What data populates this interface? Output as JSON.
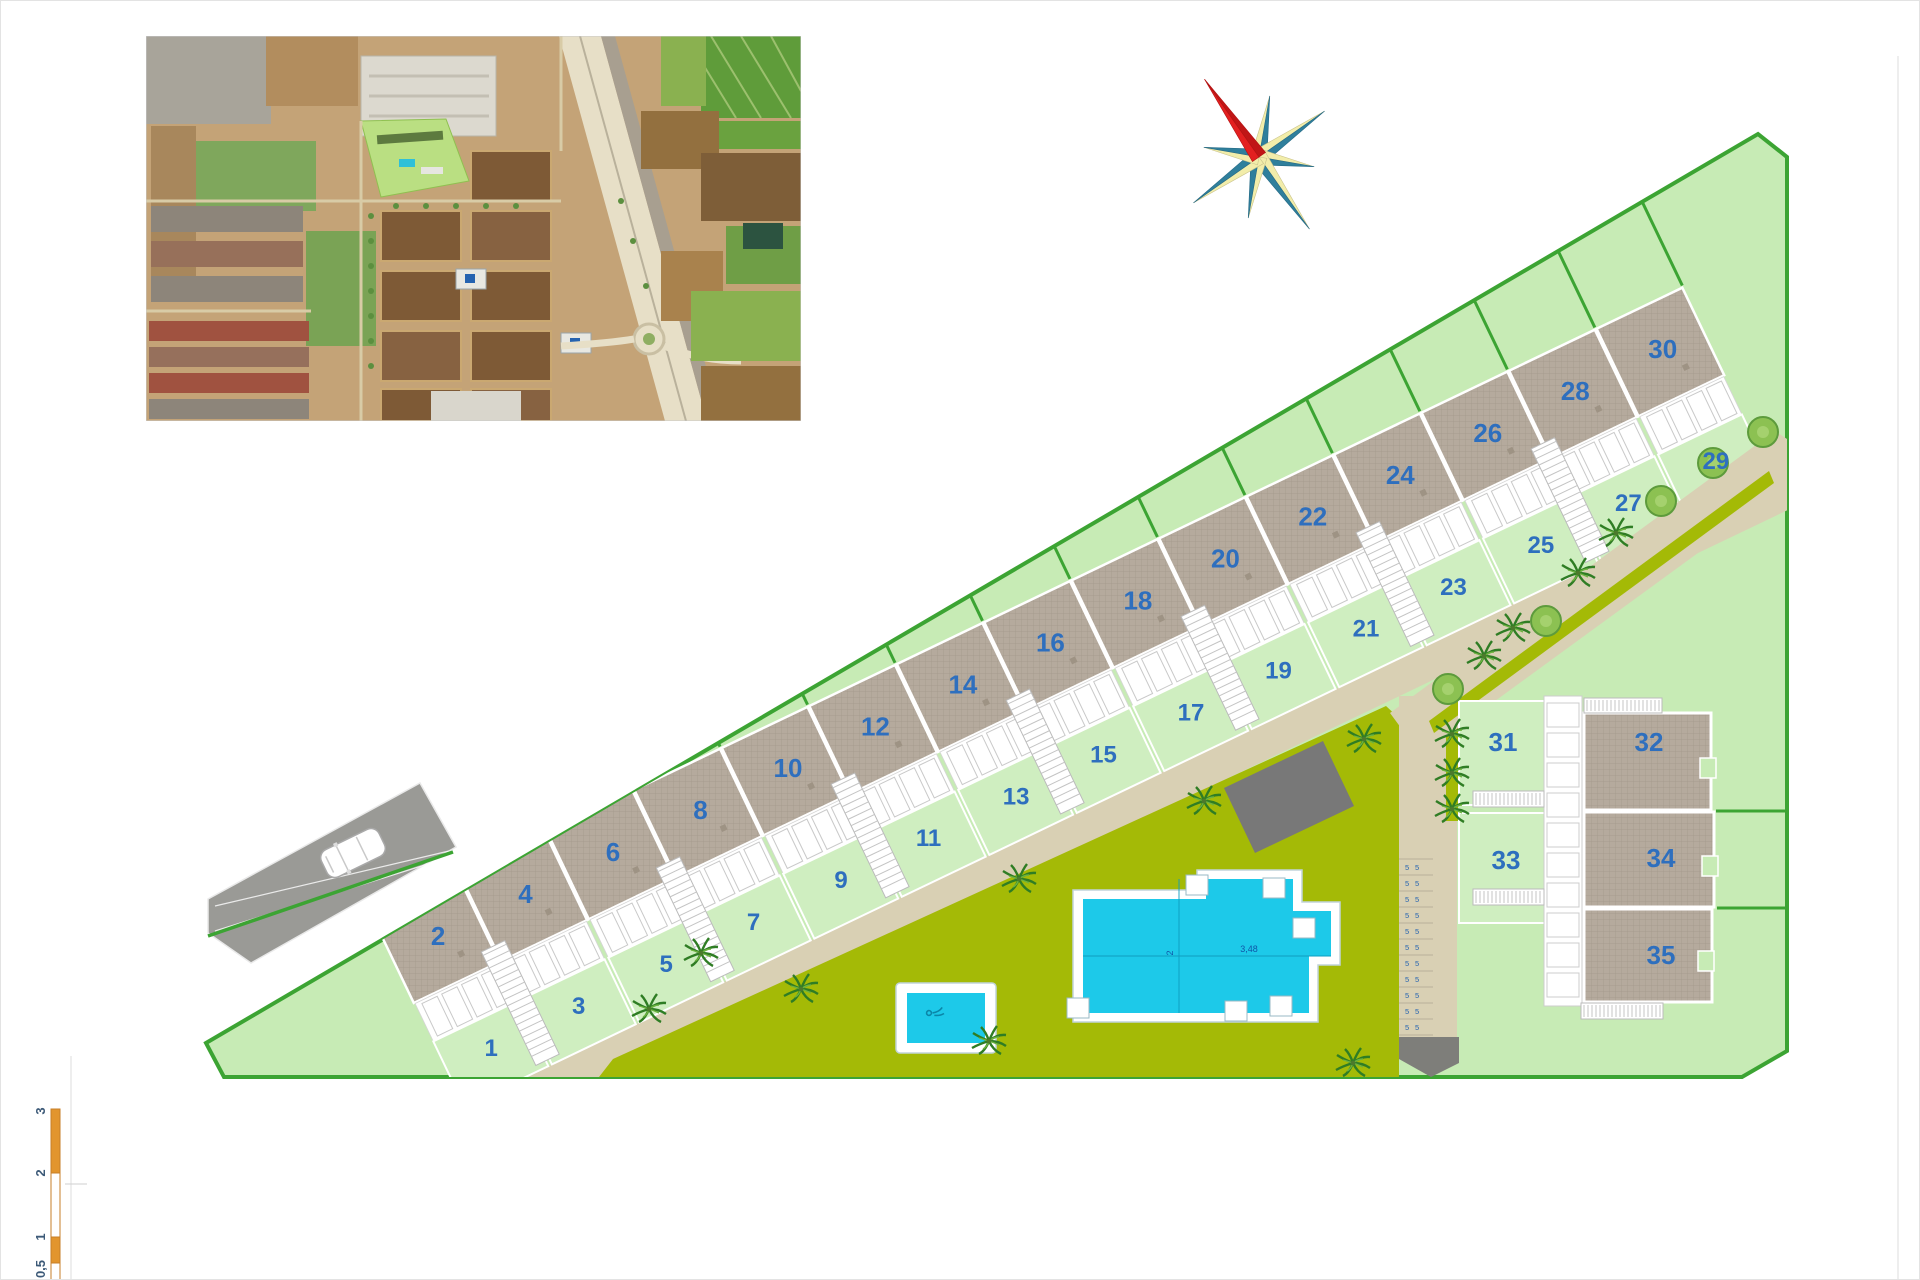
{
  "plan": {
    "row_units": [
      {
        "garden": "1",
        "roof": "2"
      },
      {
        "garden": "3",
        "roof": "4"
      },
      {
        "garden": "5",
        "roof": "6"
      },
      {
        "garden": "7",
        "roof": "8"
      },
      {
        "garden": "9",
        "roof": "10"
      },
      {
        "garden": "11",
        "roof": "12"
      },
      {
        "garden": "13",
        "roof": "14"
      },
      {
        "garden": "15",
        "roof": "16"
      },
      {
        "garden": "17",
        "roof": "18"
      },
      {
        "garden": "19",
        "roof": "20"
      },
      {
        "garden": "21",
        "roof": "22"
      },
      {
        "garden": "23",
        "roof": "24"
      },
      {
        "garden": "25",
        "roof": "26"
      },
      {
        "garden": "27",
        "roof": "28"
      },
      {
        "garden": "29",
        "roof": "30"
      }
    ],
    "cluster": {
      "garden_plots": [
        "31",
        "33"
      ],
      "building_plots": [
        "32",
        "34",
        "35"
      ]
    },
    "pool": {
      "dim_width": "2",
      "dim_length": "3,48"
    },
    "parking_mark": "5",
    "colors": {
      "site_fill": "#c7ebb5",
      "boundary": "#3ca433",
      "garden": "#cfeec0",
      "roof": "#b5aa9d",
      "roof_line": "#a3988a",
      "path": "#d9d0b4",
      "lawn": "#a4ba06",
      "pool": "#1dc9e9",
      "number_blue": "#2e6fbe",
      "driveway": "#9a9a96",
      "compass_teal": "#2f7f9c",
      "compass_cream": "#f2edaa",
      "compass_red": "#e32020",
      "scale_orange": "#e2952e"
    }
  },
  "scale_bar": {
    "labels": [
      "3",
      "2",
      "1",
      "0,5"
    ]
  }
}
